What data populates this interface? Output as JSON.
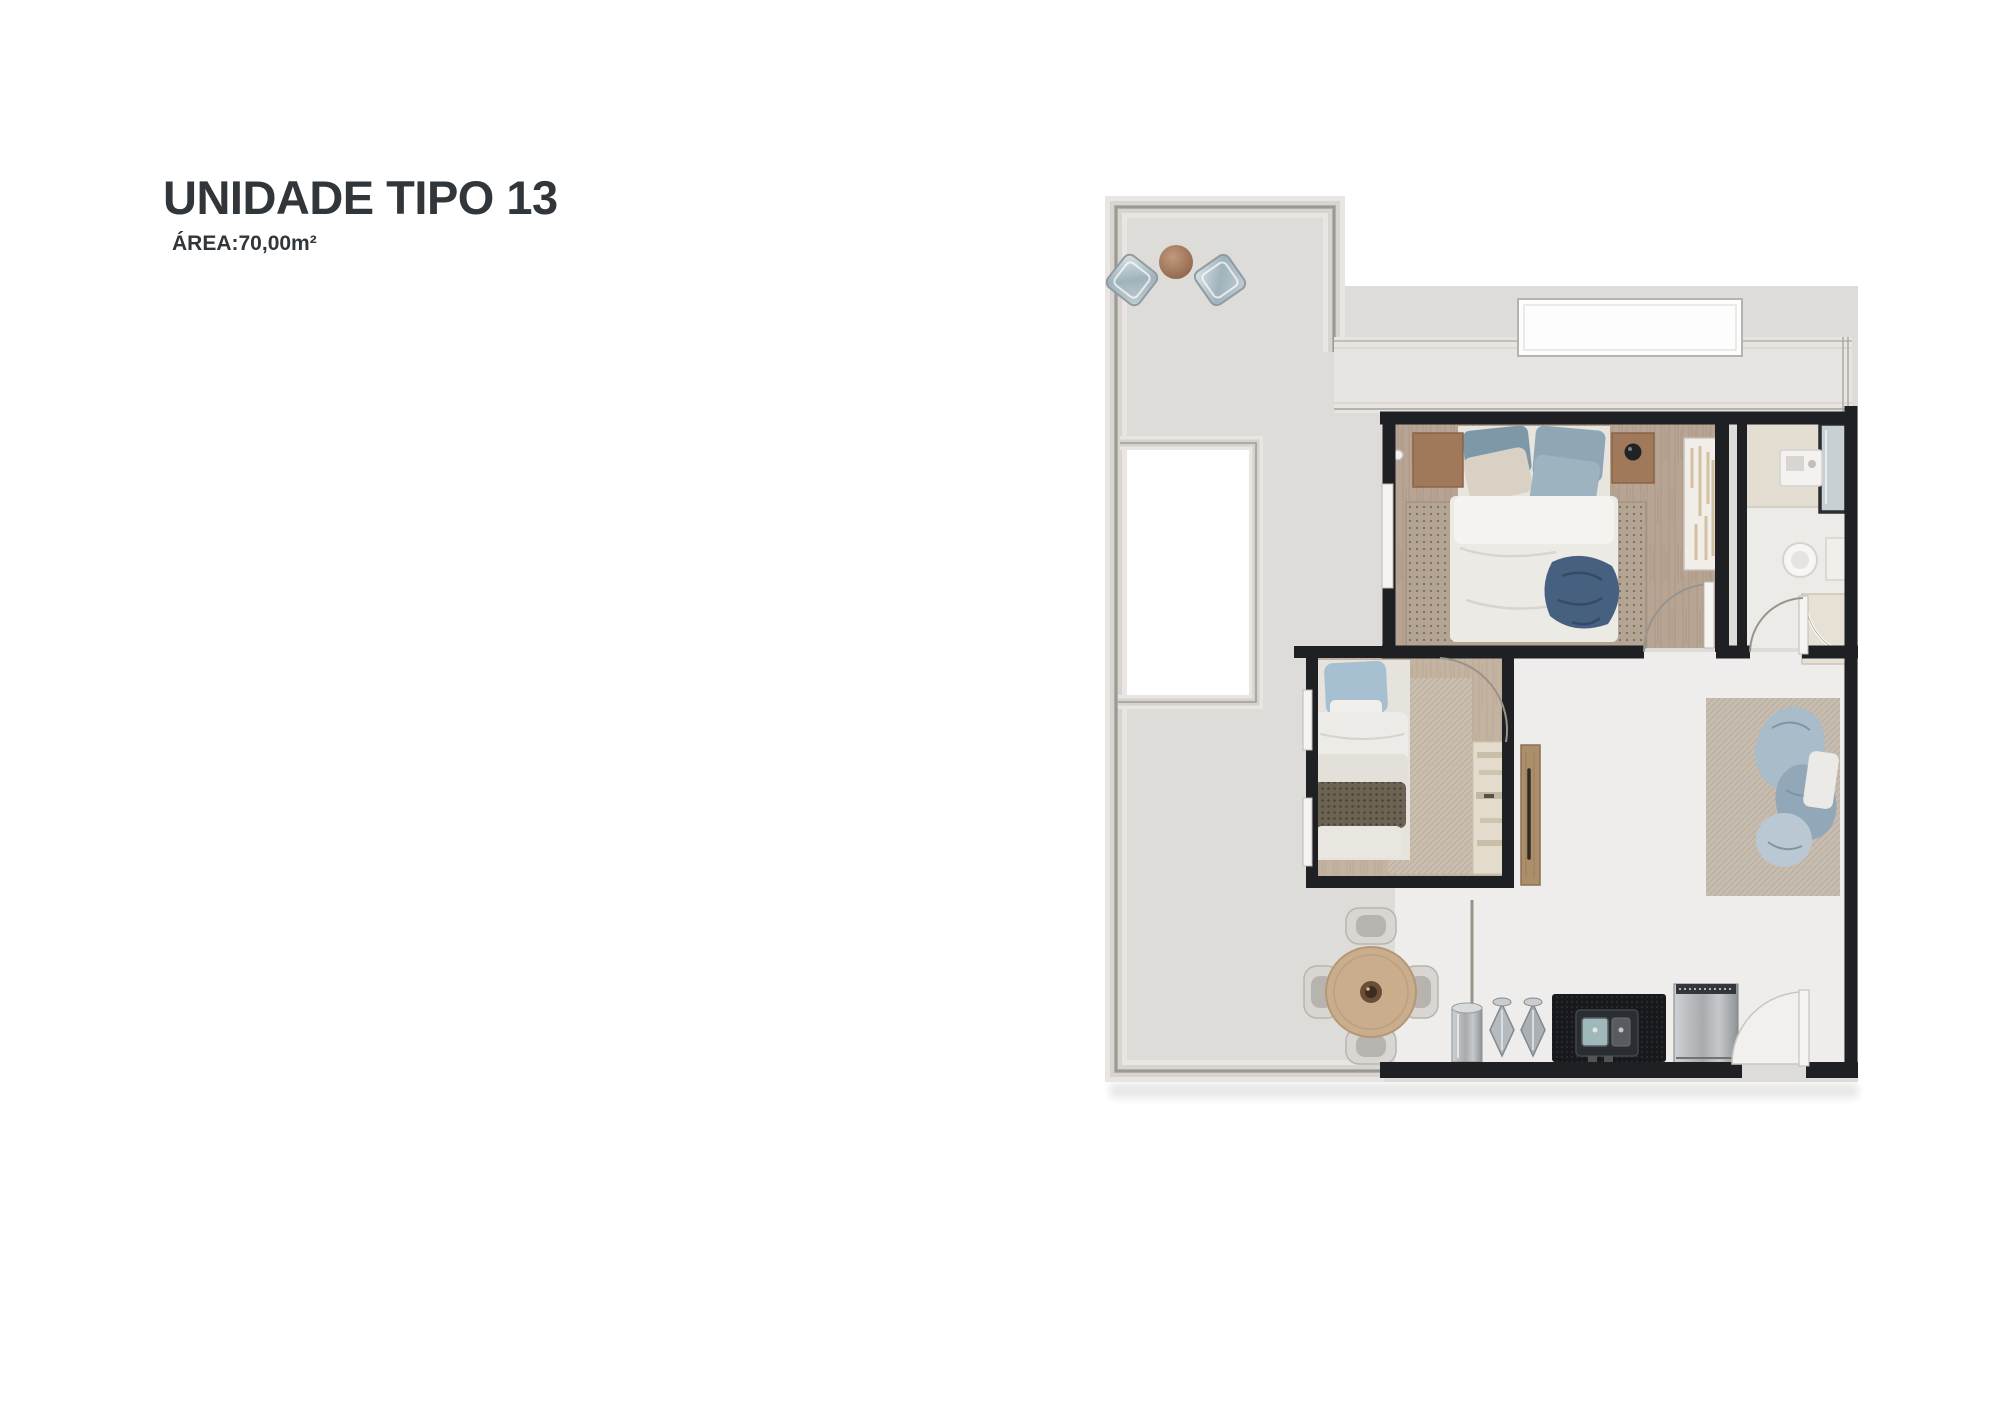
{
  "page": {
    "background": "#ffffff"
  },
  "header": {
    "title": "UNIDADE TIPO 13",
    "area": "ÁREA:70,00m²",
    "text_color": "#31363b"
  },
  "floor_plan": {
    "colors": {
      "terrace_floor": "#dedcd9",
      "interior_floor": "#eeedeb",
      "molding_silver": "#b3afaa",
      "wall_dark": "#1e2023",
      "wood_floor_master": "#b7a492",
      "wood_floor_second": "#c4b3a1",
      "rug_beige": "#b3a493",
      "bedding_blue": "#8ea7b6",
      "denim_blue": "#46617f",
      "knit_brown": "#6d6352",
      "counter_black": "#17191c",
      "appliance_steel": "#b9bcbe",
      "table_wood": "#c9ad8d",
      "terrace_ball_wood": "#a97f5e"
    }
  }
}
